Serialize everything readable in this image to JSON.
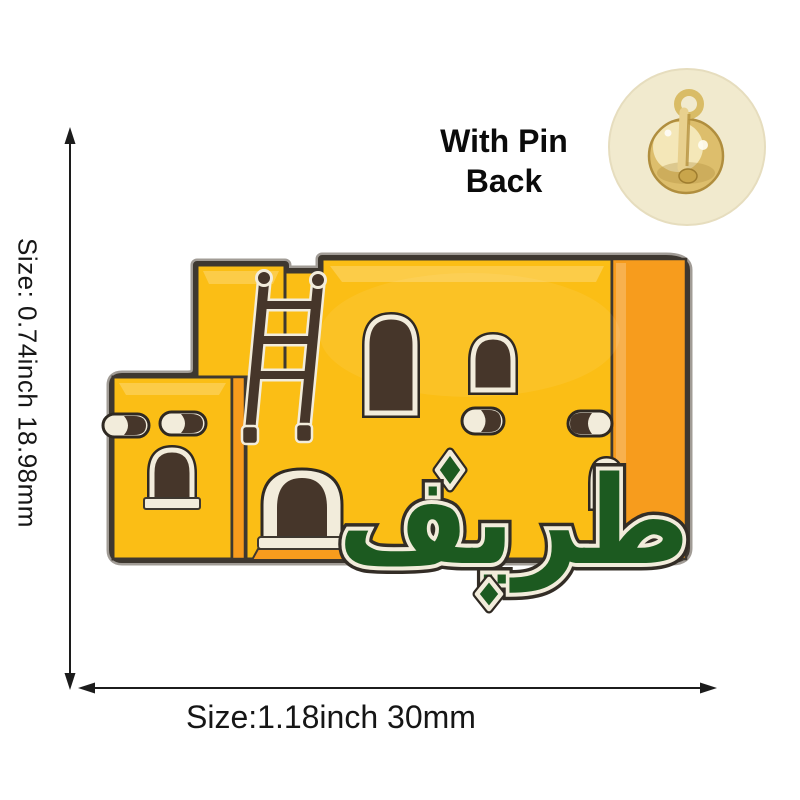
{
  "annotations": {
    "vertical_size_label": "Size: 0.74inch 18.98mm",
    "horizontal_size_label": "Size:1.18inch 30mm",
    "pin_back_label": "With Pin Back"
  },
  "pin": {
    "arabic_text": "طريف",
    "colors": {
      "enamel_yellow": "#FBBE15",
      "enamel_orange": "#F79C1D",
      "enamel_green": "#1C5A20",
      "window_brown": "#46362A",
      "metal_cream": "#F2ECDB",
      "metal_dark": "#3E3830",
      "rim_light": "#A19C96",
      "gold": "#DDBE6C",
      "gold_light": "#F8EEC6",
      "gold_dark": "#B08E3E",
      "inset_bg": "#F1EACE"
    }
  }
}
